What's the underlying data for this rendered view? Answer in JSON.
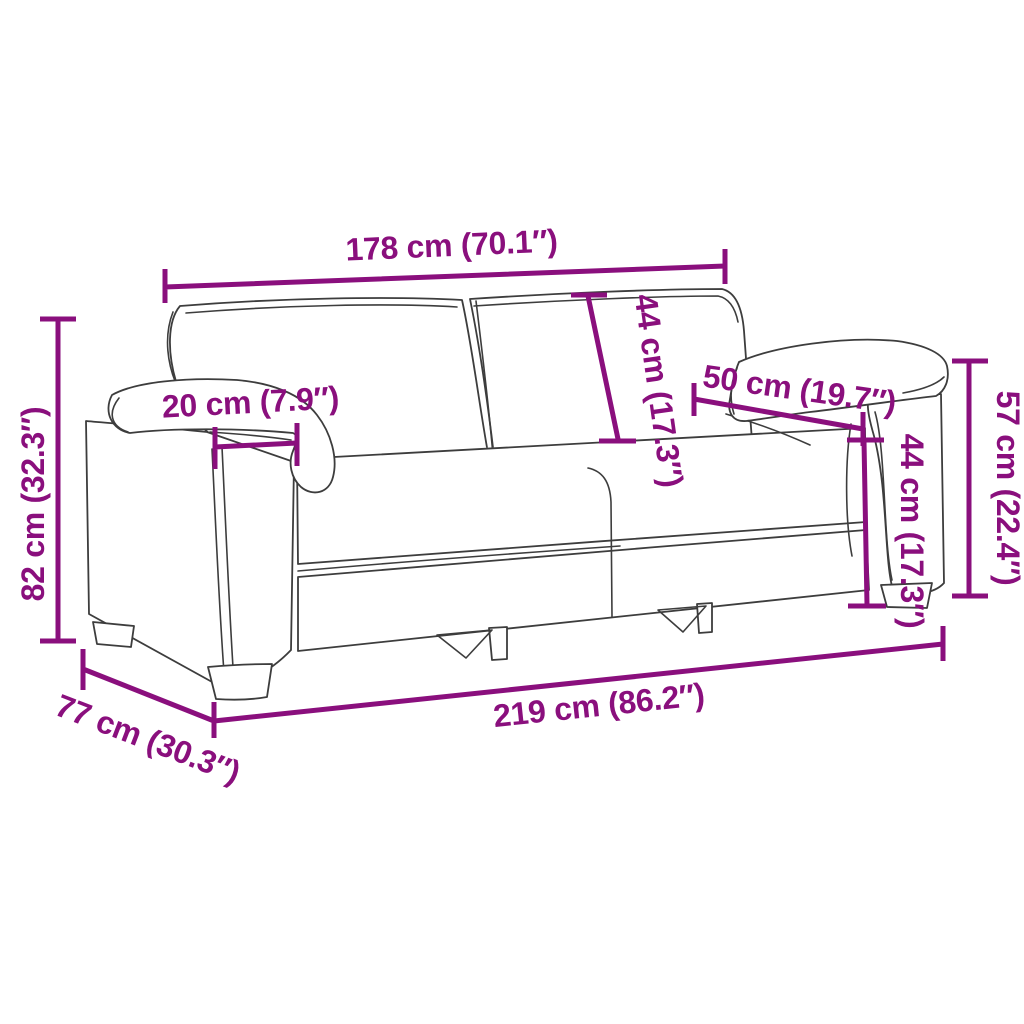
{
  "diagram": {
    "type": "product dimension diagram",
    "subject": "2-seater sofa line sketch",
    "background_color": "#ffffff",
    "accent_color": "#8A0F7D",
    "sketch_color": "#3d3d3d"
  },
  "labels": {
    "back_width": "178 cm (70.1″)",
    "back_cushion_height": "44 cm (17.3″)",
    "armrest_length": "50 cm (19.7″)",
    "arm_inner_height": "44 cm (17.3″)",
    "arm_height": "57 cm (22.4″)",
    "armrest_width": "20 cm (7.9″)",
    "overall_height": "82 cm (32.3″)",
    "overall_depth": "77 cm (30.3″)",
    "overall_width": "219 cm (86.2″)"
  },
  "measurements": [
    {
      "name": "back width",
      "cm": 178,
      "inches": 70.1
    },
    {
      "name": "back cushion height",
      "cm": 44,
      "inches": 17.3
    },
    {
      "name": "armrest length",
      "cm": 50,
      "inches": 19.7
    },
    {
      "name": "arm inner height",
      "cm": 44,
      "inches": 17.3
    },
    {
      "name": "arm height",
      "cm": 57,
      "inches": 22.4
    },
    {
      "name": "armrest width",
      "cm": 20,
      "inches": 7.9
    },
    {
      "name": "overall height",
      "cm": 82,
      "inches": 32.3
    },
    {
      "name": "overall depth",
      "cm": 77,
      "inches": 30.3
    },
    {
      "name": "overall width",
      "cm": 219,
      "inches": 86.2
    }
  ]
}
